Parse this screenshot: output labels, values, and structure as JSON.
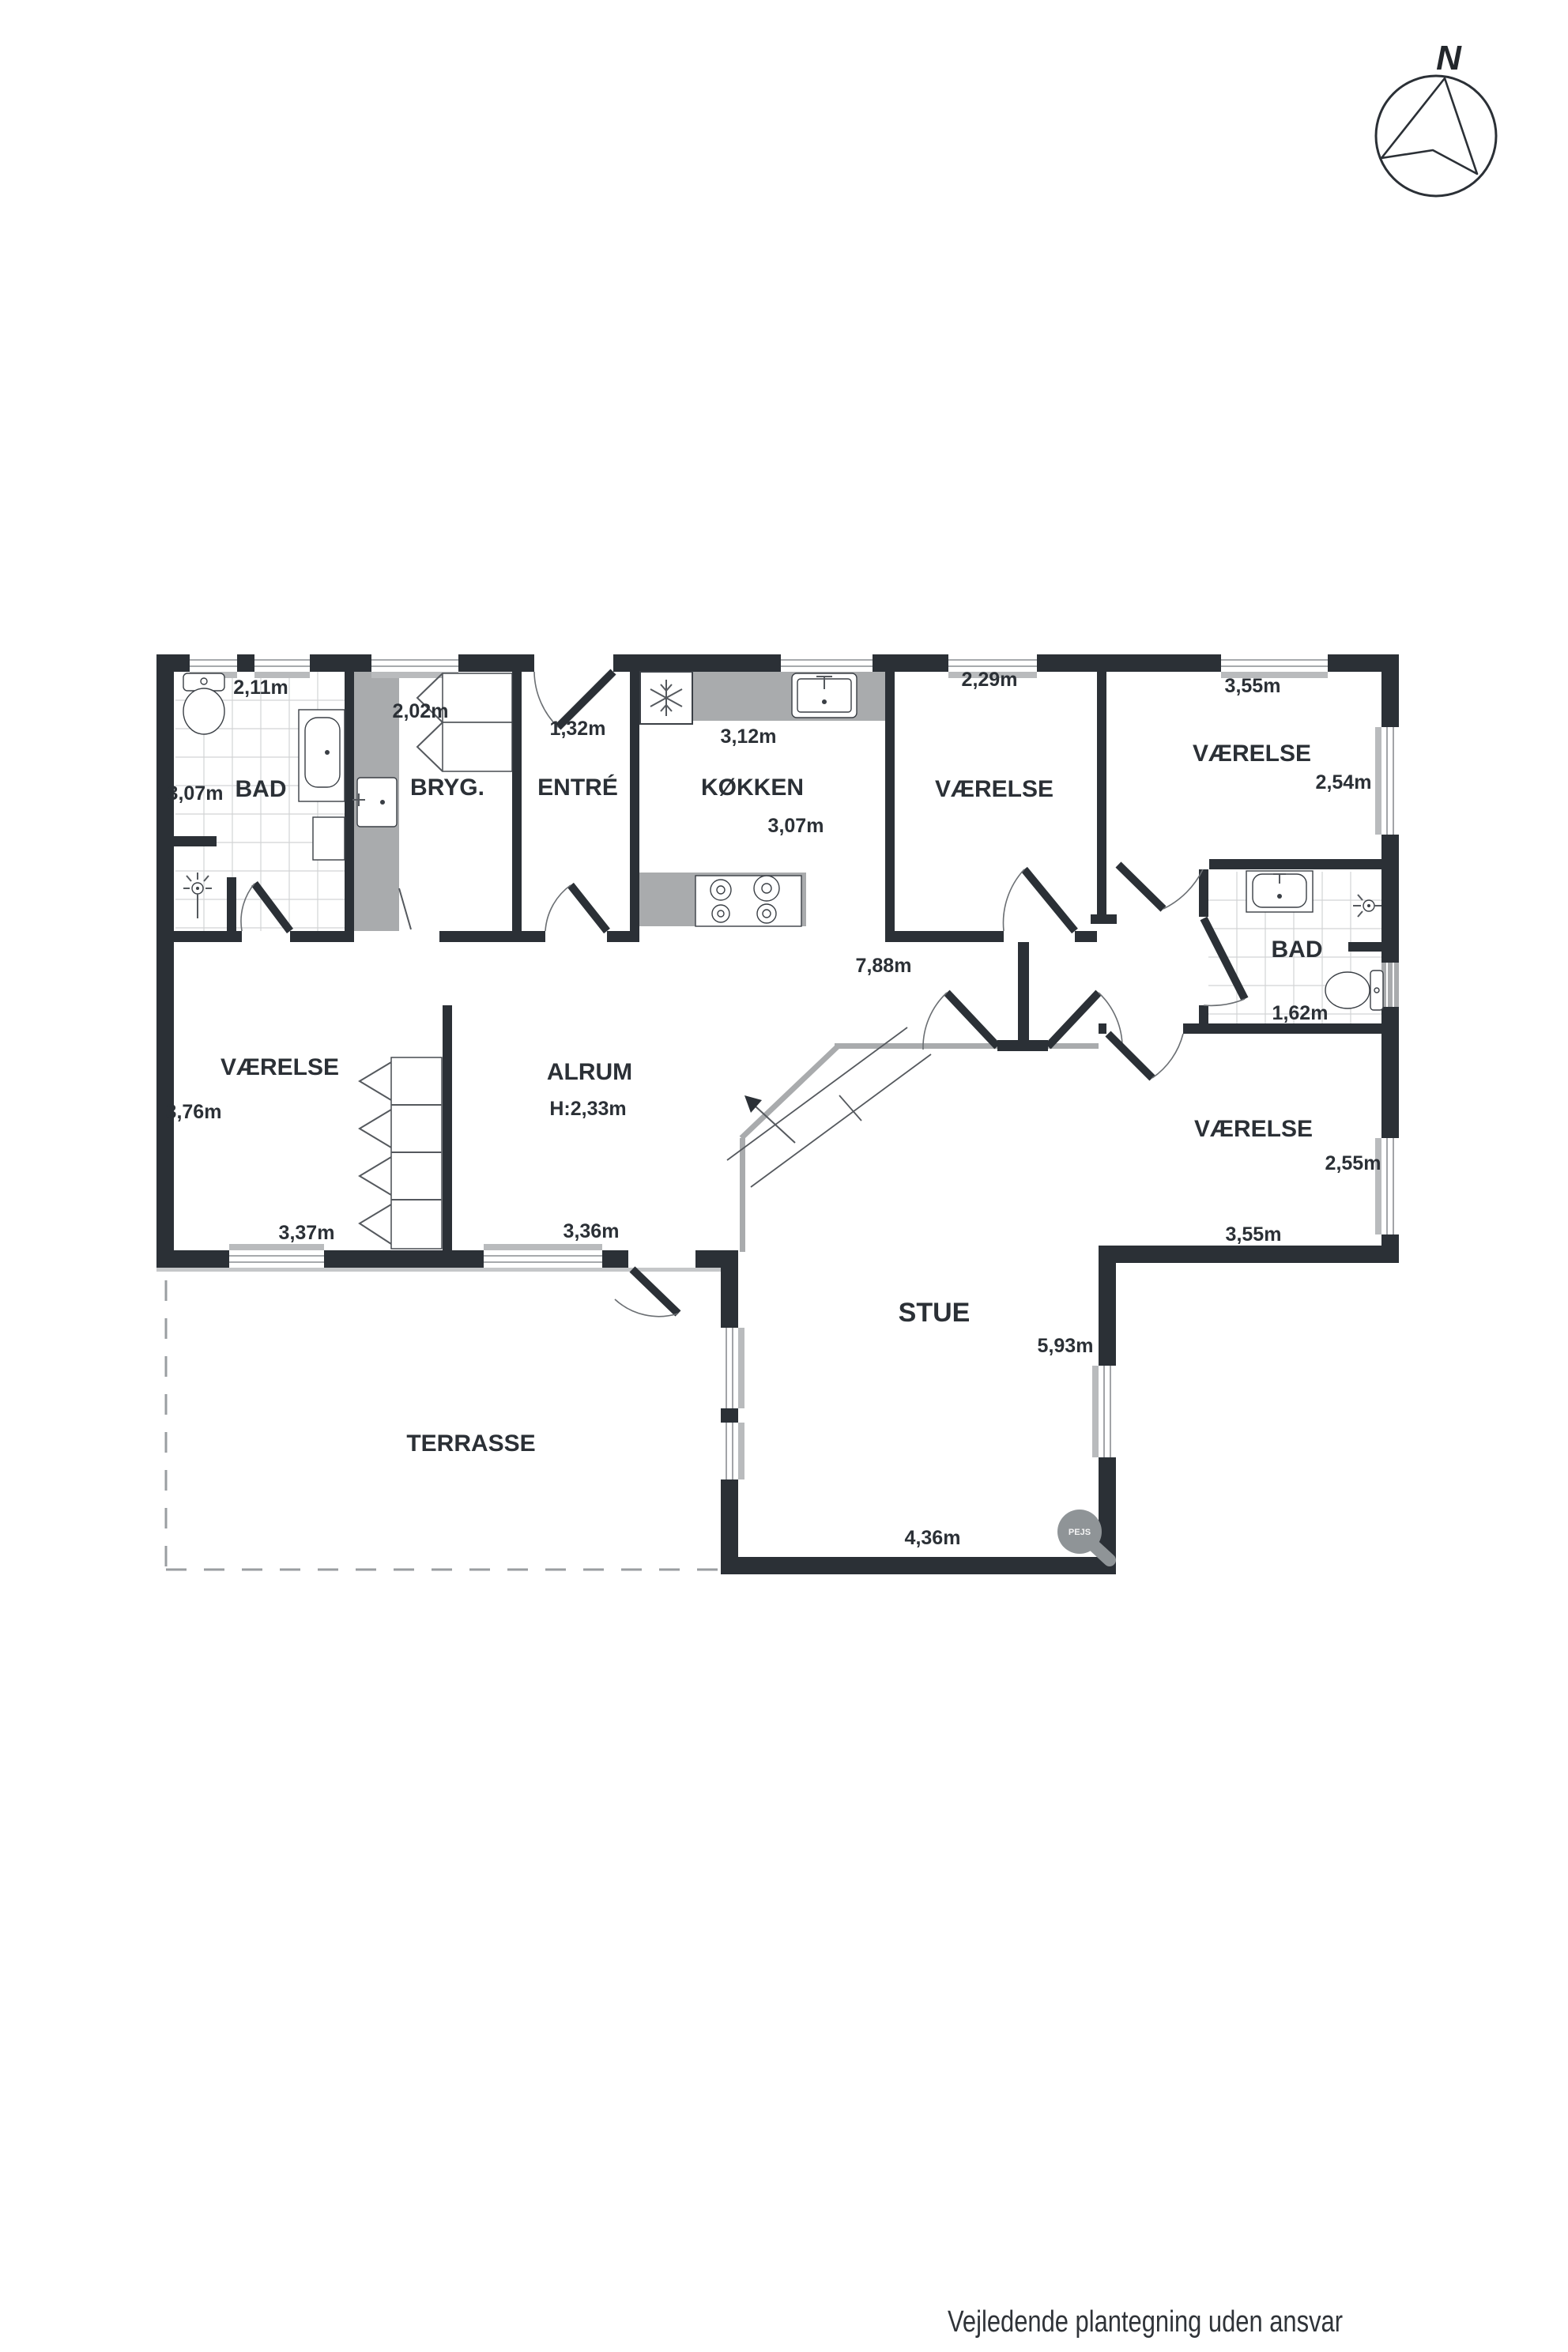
{
  "compass": {
    "north_label": "N"
  },
  "footer": {
    "disclaimer": "Vejledende plantegning uden ansvar"
  },
  "plan": {
    "bad_nw": {
      "name": "BAD",
      "width": "2,11m",
      "depth": "3,07m"
    },
    "bryggers": {
      "name": "BRYG.",
      "width": "2,02m"
    },
    "entre": {
      "name": "ENTRÉ",
      "door_width": "1,32m"
    },
    "kokken": {
      "name": "KØKKEN",
      "width": "3,12m",
      "depth": "3,07m"
    },
    "vaerelse_n": {
      "name": "VÆRELSE",
      "width": "2,29m"
    },
    "vaerelse_ne": {
      "name": "VÆRELSE",
      "width": "3,55m",
      "depth": "2,54m"
    },
    "bad_e": {
      "name": "BAD",
      "width": "1,62m"
    },
    "gang": {
      "length": "7,88m"
    },
    "vaerelse_w": {
      "name": "VÆRELSE",
      "depth": "3,76m",
      "width": "3,37m"
    },
    "alrum": {
      "name": "ALRUM",
      "ceiling_height": "H:2,33m",
      "width": "3,36m"
    },
    "vaerelse_se": {
      "name": "VÆRELSE",
      "depth": "2,55m",
      "width": "3,55m"
    },
    "stue": {
      "name": "STUE",
      "depth": "5,93m",
      "width": "4,36m"
    },
    "terrasse": {
      "name": "TERRASSE"
    },
    "pejs": {
      "label": "PEJS"
    }
  },
  "icons": {
    "navigation": "compass-north-icon",
    "fridge": "snowflake-icon",
    "stairs": "stairs-up-arrow-icon",
    "fireplace": "fireplace-pejs-icon"
  },
  "colors": {
    "wall": "#2b3036",
    "counter_gray": "#a9abad",
    "background": "#ffffff"
  }
}
